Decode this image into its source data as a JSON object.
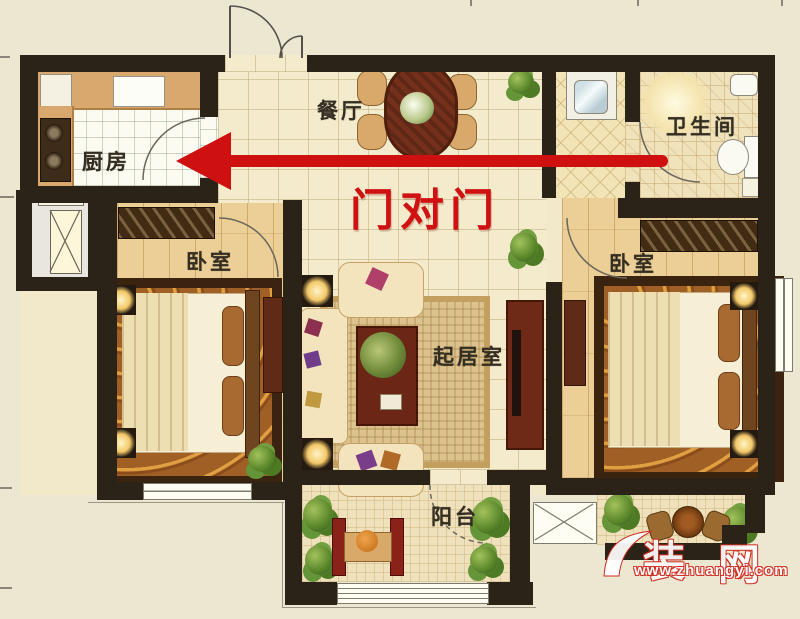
{
  "plan_title": "two-bedroom floor plan",
  "rooms": {
    "kitchen": {
      "label": "厨房"
    },
    "dining": {
      "label": "餐厅"
    },
    "bathroom": {
      "label": "卫生间"
    },
    "bedroom_left": {
      "label": "卧室"
    },
    "living": {
      "label": "起居室"
    },
    "bedroom_right": {
      "label": "卧室"
    },
    "balcony": {
      "label": "阳台"
    }
  },
  "annotation": {
    "text": "门对门",
    "color": "#d01111",
    "arrow_direction": "left"
  },
  "watermark": {
    "brand_char_left": "装",
    "brand_char_right": "网",
    "url": "www.zhuangyi.com"
  },
  "colors": {
    "background": "#ece7d0",
    "walls": "#2c2318",
    "accent_red": "#ce1110",
    "wood_floor": "#ebcf96"
  }
}
